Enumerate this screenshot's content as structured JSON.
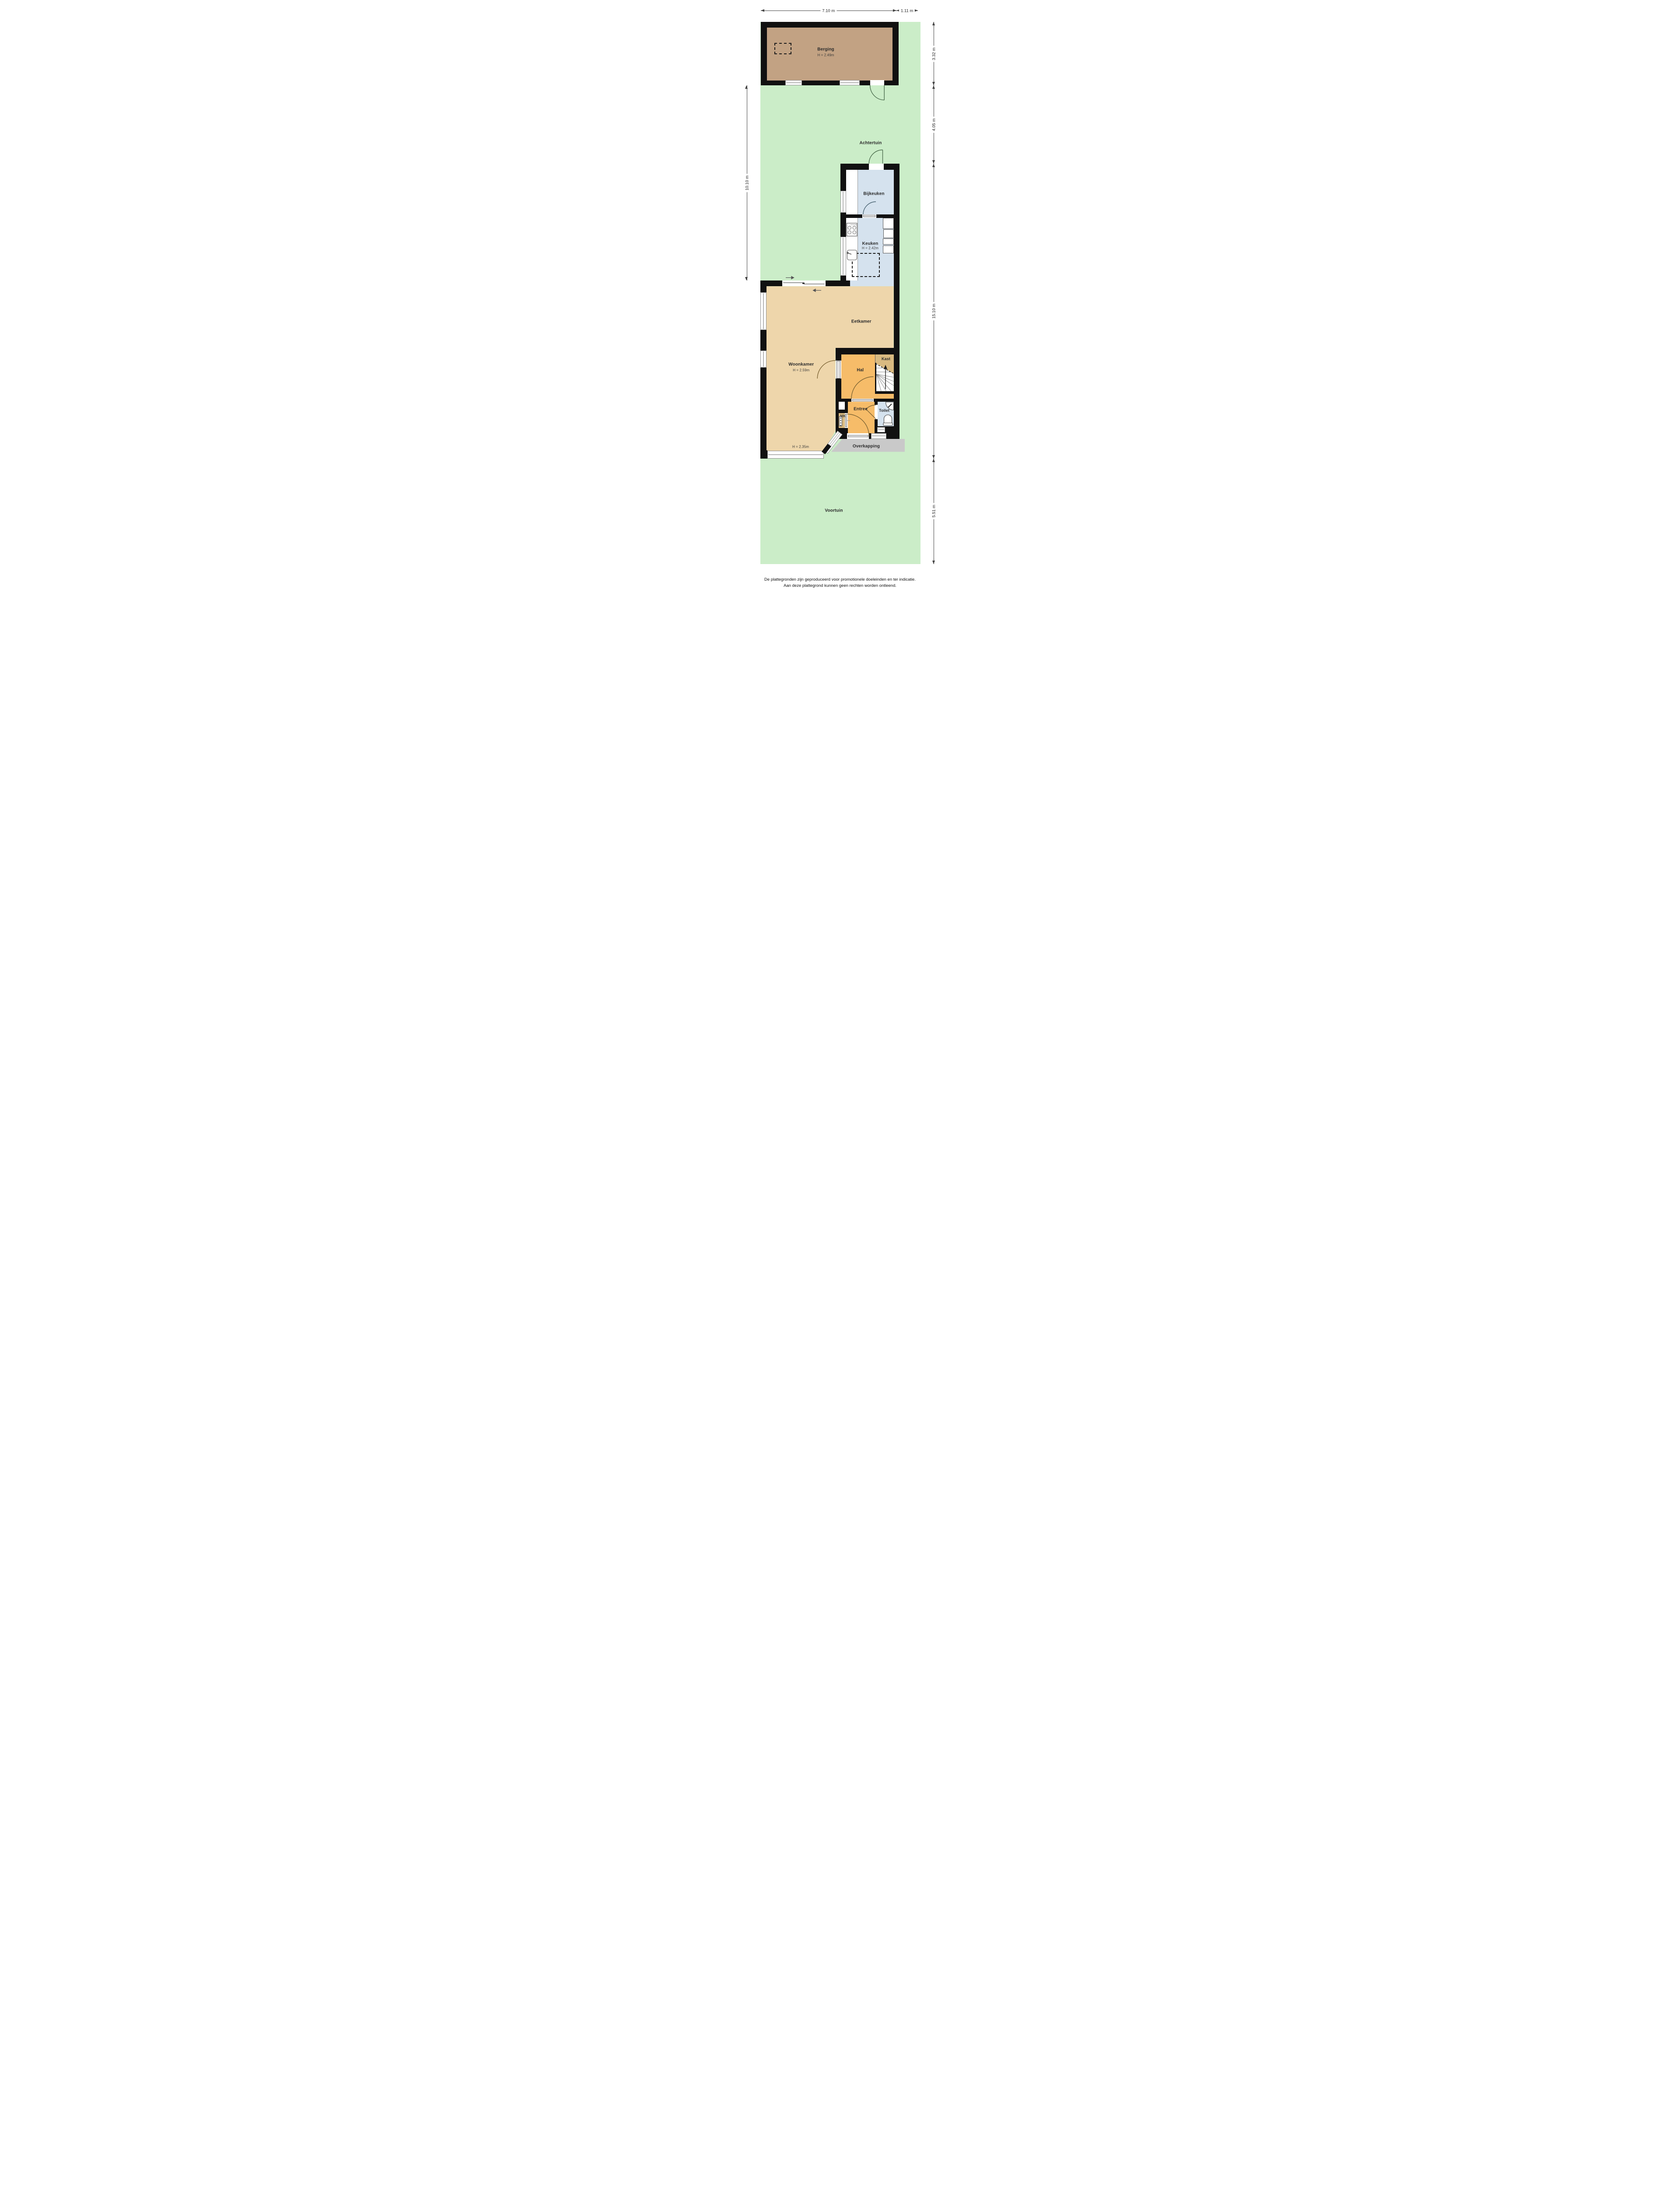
{
  "meta": {
    "type": "floor-plan",
    "floor": "begane grond met tuin"
  },
  "colors": {
    "garden": "#cbedc8",
    "berging-floor": "#c2a283",
    "wet-floor": "#d5e2ee",
    "living-floor": "#eed6ab",
    "hall-floor": "#f6bc69",
    "closet-floor": "#d9ba81",
    "canopy": "#c9c9c9",
    "wall": "#111111",
    "dim": "#444444",
    "arc-ext": "#4a6b4c",
    "arc-int": "#7c6434",
    "arc-kitchen": "#4a6472"
  },
  "dimensions": {
    "top": [
      "7.10 m",
      "1.11 m"
    ],
    "left": [
      "10.10 m"
    ],
    "right": [
      "3.32 m",
      "4.05 m",
      "15.10 m",
      "5.51 m"
    ]
  },
  "rooms": {
    "berging": {
      "name": "Berging",
      "height": "H = 2.49m"
    },
    "achtertuin": {
      "name": "Achtertuin"
    },
    "bijkeuken": {
      "name": "Bijkeuken"
    },
    "keuken": {
      "name": "Keuken",
      "height": "H = 2.42m"
    },
    "eetkamer": {
      "name": "Eetkamer"
    },
    "woonkamer": {
      "name": "Woonkamer",
      "height": "H = 2.59m",
      "height2": "H = 2.35m"
    },
    "hal": {
      "name": "Hal"
    },
    "kast": {
      "name": "Kast"
    },
    "mk": {
      "name": "MK"
    },
    "entree": {
      "name": "Entree"
    },
    "toilet": {
      "name": "Toilet"
    },
    "overkapping": {
      "name": "Overkapping"
    },
    "voortuin": {
      "name": "Voortuin"
    }
  },
  "footer": {
    "line1": "De plattegronden zijn geproduceerd voor promotionele doeleinden en ter indicatie.",
    "line2": "Aan deze plattegrond kunnen geen rechten worden ontleend."
  }
}
